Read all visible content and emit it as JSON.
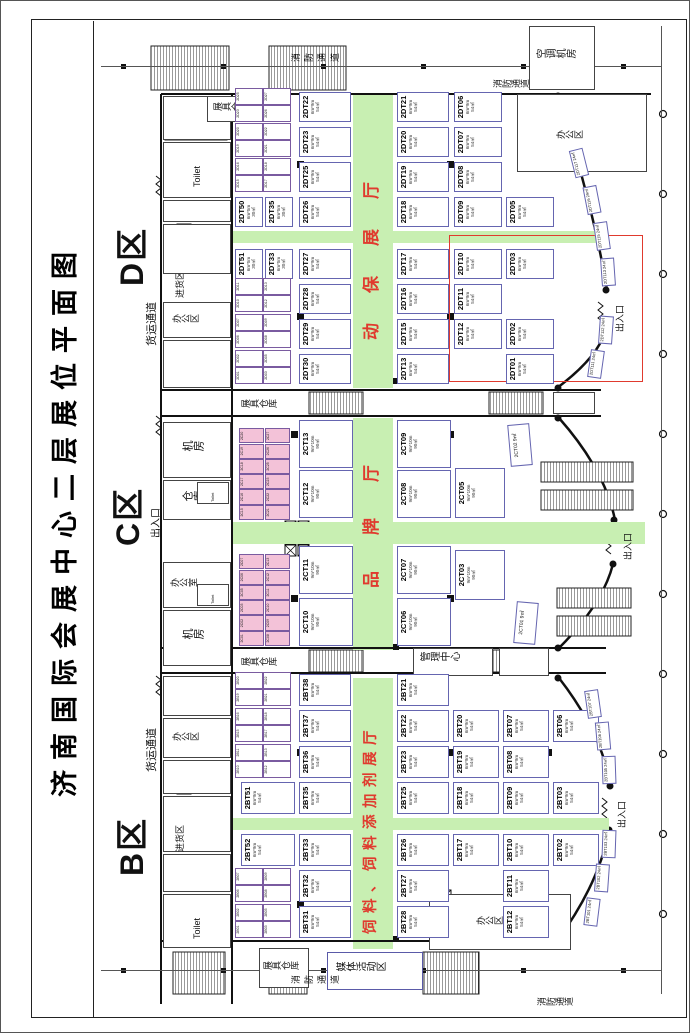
{
  "title": "济南国际会展中心二层展位平面图",
  "zones": {
    "b": "B区",
    "c": "C区",
    "d": "D区"
  },
  "hall_names": {
    "b": "饲料、饲料添加剂展厅",
    "c": "品牌厅",
    "d": "动保展厅",
    "intl_col1": "国际",
    "intl_col2": "展区"
  },
  "labels": {
    "fire_lane": "消防通道",
    "freight_lane": "货运通道",
    "entrance": "出入口",
    "goods_in": "进货区",
    "office_area": "办公区",
    "office_room": "办公室",
    "machine_room": "机房",
    "warehouse": "仓库",
    "booth_store": "展具仓库",
    "toilet": "Toilet",
    "media_area": "媒体活动区",
    "mgmt_center": "管理中心",
    "hvac_room": "空调机房"
  },
  "sizes": {
    "std": "6m*9m\n54㎡",
    "large": "9m*10m\n90㎡",
    "pair": "6m*5m\n30㎡",
    "small": "9㎡",
    "tilted": "24㎡"
  },
  "booths": {
    "d_pairs_top": [
      "2DT51",
      "2DT50"
    ],
    "d_pairs_bottom": [
      "2DT33",
      "2DT35"
    ],
    "d_row_a": [
      "2DT30",
      "2DT29",
      "2DT28",
      "2DT27",
      "2DT26",
      "2DT25",
      "2DT23",
      "2DT22"
    ],
    "d_row_b": [
      "2DT13",
      "2DT15",
      "2DT16",
      "2DT17",
      "2DT18",
      "2DT19",
      "2DT20",
      "2DT21"
    ],
    "d_row_c": [
      "2DT12",
      "2DT11",
      "2DT10",
      "2DT09",
      "2DT08",
      "2DT07",
      "2DT06"
    ],
    "d_row_d": [
      "2DT01",
      "2DT02",
      "2DT03",
      "2DT05"
    ],
    "d_wall": [
      "2DT111",
      "2DT112",
      "2DT113",
      "2DT115",
      "2DT116",
      "2DT117"
    ],
    "c_row_1": [
      "2CT10",
      "2CT11",
      "2CT12",
      "2CT13"
    ],
    "c_row_2": [
      "2CT06",
      "2CT07",
      "2CT08",
      "2CT09"
    ],
    "c_row_3": [
      "2CT03",
      "2CT05"
    ],
    "c_wall": [
      "2CT01",
      "2CT02"
    ],
    "b_top": [
      "2BT52",
      "2BT51"
    ],
    "b_row_1": [
      "2BT31",
      "2BT32",
      "2BT33",
      "2BT35",
      "2BT36",
      "2BT37",
      "2BT38"
    ],
    "b_row_2": [
      "2BT28",
      "2BT27",
      "2BT26",
      "2BT25",
      "2BT23",
      "2BT22",
      "2BT21"
    ],
    "b_row_3": [
      "2BT17",
      "2BT18",
      "2BT19",
      "2BT20"
    ],
    "b_row_4": [
      "2BT12",
      "2BT11",
      "2BT10",
      "2BT09",
      "2BT08",
      "2BT07"
    ],
    "b_row_5": [
      "2BT02",
      "2BT03",
      "2BT06"
    ],
    "b_wall": [
      "2BT101",
      "2BT102",
      "2BT103",
      "2BT105",
      "2BT106",
      "2BT107"
    ],
    "d_small": [
      "2D01",
      "2D02",
      "2D03",
      "2D05",
      "2D06",
      "2D07",
      "2D08",
      "2D09",
      "2D10",
      "2D11",
      "2D12",
      "2D13",
      "2D15",
      "2D16",
      "2D17",
      "2D18",
      "2D19",
      "2D20",
      "2D21",
      "2D22",
      "2D23",
      "2D25",
      "2D26",
      "2D27"
    ],
    "b_small": [
      "2B01",
      "2B02",
      "2B03",
      "2B05",
      "2B06",
      "2B07",
      "2B08",
      "2B09",
      "2B10",
      "2B11",
      "2B12",
      "2B13",
      "2B15",
      "2B16",
      "2B17",
      "2B18",
      "2B19",
      "2B20",
      "2B21",
      "2B22"
    ],
    "c_small": [
      "2C01",
      "2C02",
      "2C03",
      "2C05",
      "2C06",
      "2C07",
      "2C08",
      "2C09",
      "2C10",
      "2C11",
      "2C12",
      "2C13",
      "2C15",
      "2C16",
      "2C17",
      "2C18",
      "2C19",
      "2C20",
      "2C21",
      "2C22",
      "2C23",
      "2C25",
      "2C26",
      "2C27"
    ]
  }
}
